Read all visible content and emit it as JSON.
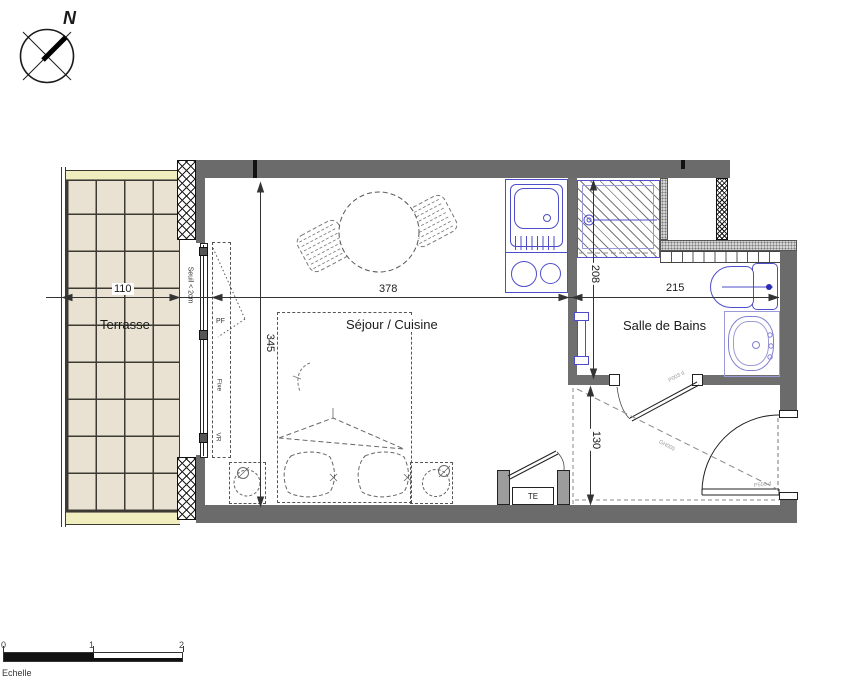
{
  "compass": {
    "north": "N"
  },
  "terrace": {
    "label": "Terrasse",
    "width_dim": "110"
  },
  "window": {
    "threshold": "Seuil < 2cm",
    "pf": "PF",
    "fixed": "Fixe",
    "shutter": "VR"
  },
  "living": {
    "label": "Séjour / Cuisine",
    "width_dim": "378",
    "height_dim": "345"
  },
  "bathroom": {
    "label": "Salle de Bains",
    "width_dim": "215",
    "height_dim": "208",
    "door_code": "P003 d"
  },
  "entry": {
    "height_dim": "130",
    "panel": "TE",
    "door_code": "P500 d",
    "note_code": "GH005"
  },
  "scalebar": {
    "label": "Echelle",
    "ticks": [
      "0",
      "1",
      "2"
    ]
  },
  "colors": {
    "wall_gray": "#6b6b6b",
    "fixture_blue": "#4d4dc9",
    "terrace_tile": "#e9e2d2",
    "accent_yellow": "#f0eebf"
  }
}
